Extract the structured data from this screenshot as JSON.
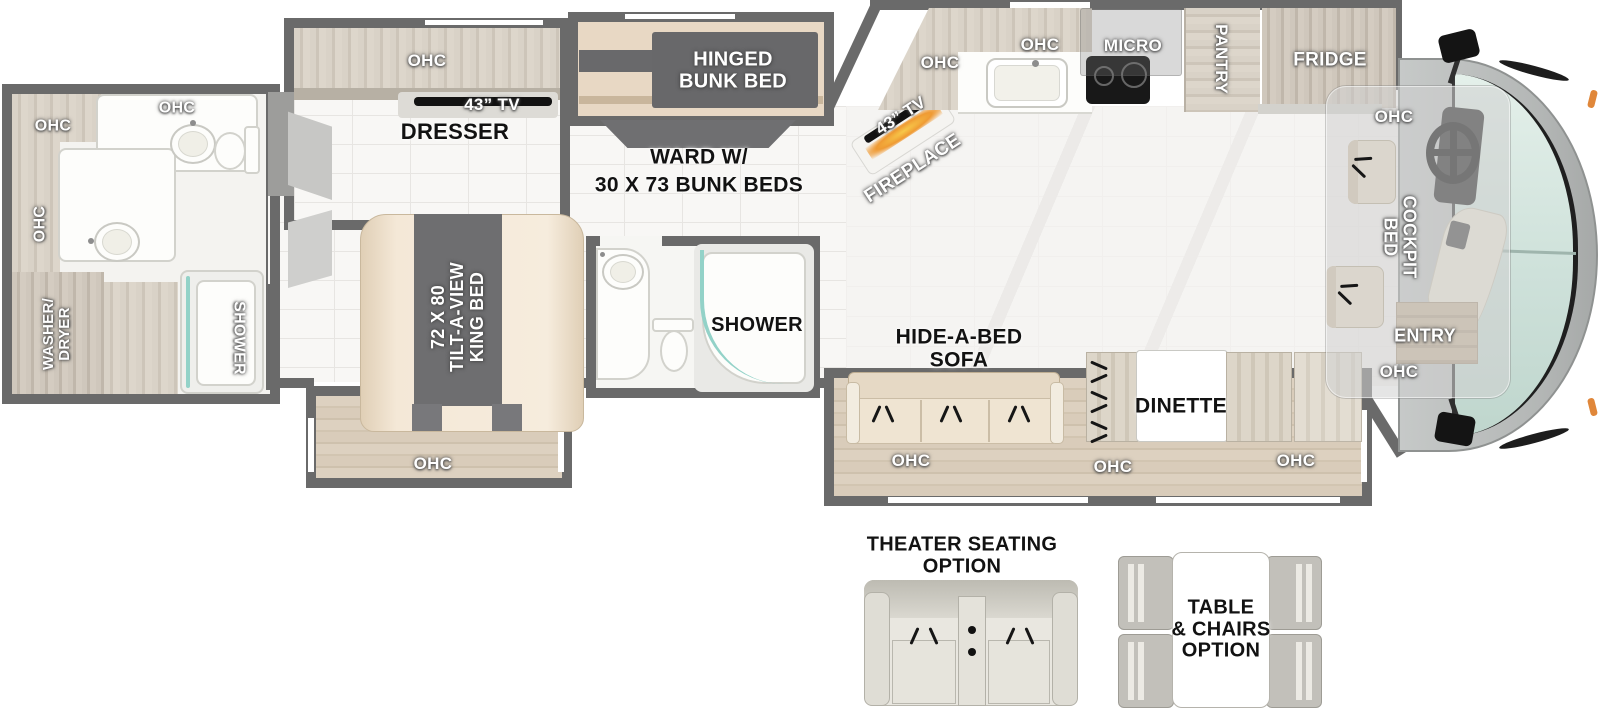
{
  "rear_bath": {
    "ohc_corner": "OHC",
    "ohc_top": "OHC",
    "ohc_side": "OHC",
    "washer_dryer": "WASHER/\nDRYER",
    "shower": "SHOWER"
  },
  "bedroom": {
    "ohc": "OHC",
    "tv": "43” TV",
    "dresser": "DRESSER",
    "king_bed": "72 X 80\nTILT-A-VIEW\nKING BED",
    "ohc_foot": "OHC"
  },
  "bunk_room": {
    "hinged_bunk": "HINGED\nBUNK BED",
    "ward": "WARD W/\n30 X 73 BUNK BEDS"
  },
  "mid_bath": {
    "shower": "SHOWER"
  },
  "kitchen": {
    "tv": "43” TV",
    "fireplace": "FIREPLACE",
    "ohc_corner": "OHC",
    "ohc": "OHC",
    "micro": "MICRO",
    "pantry": "PANTRY",
    "fridge": "FRIDGE"
  },
  "living": {
    "sofa": "HIDE-A-BED\nSOFA",
    "dinette": "DINETTE",
    "ohc_sofa": "OHC",
    "ohc_dinette": "OHC",
    "ohc_front": "OHC"
  },
  "cockpit": {
    "ohc_top": "OHC",
    "bed": "COCKPIT\nBED",
    "entry": "ENTRY",
    "ohc_bottom": "OHC"
  },
  "options": {
    "theater": "THEATER SEATING\nOPTION",
    "table_chairs": "TABLE\n& CHAIRS\nOPTION"
  },
  "colors": {
    "wall": "#6a6a6a",
    "wood": "#d6cfc3",
    "dark_panel": "#69696b",
    "bed_tan": "#f2e6d4",
    "teal_glass": "#93d2c8",
    "windshield": "#d3e6df",
    "marker_orange": "#e0873a",
    "fireplace_glow": "#f2a93b",
    "floor_wood": "#d8cdbd",
    "tile": "#f8f7f5"
  }
}
